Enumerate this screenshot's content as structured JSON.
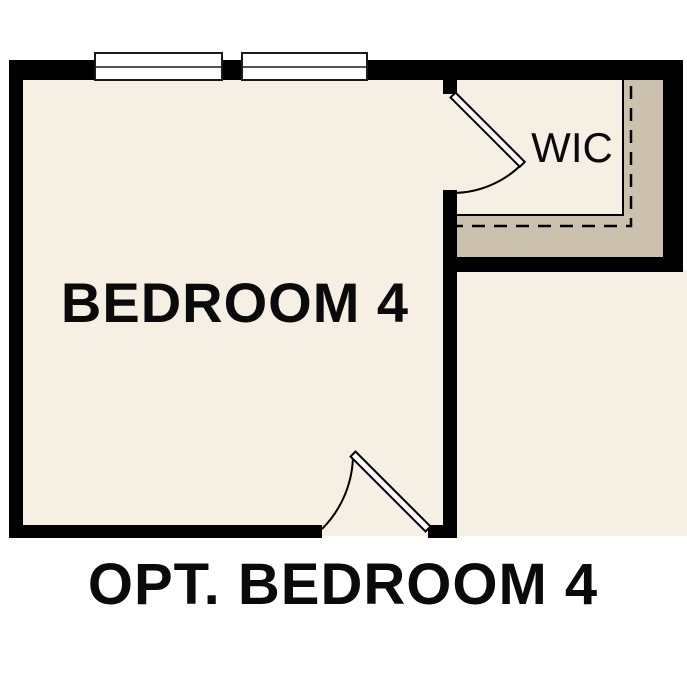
{
  "plan": {
    "caption": "OPT. BEDROOM 4",
    "rooms": [
      {
        "id": "bedroom4",
        "label": "BEDROOM 4"
      },
      {
        "id": "wic",
        "label": "WIC"
      }
    ]
  },
  "colors": {
    "background": "#ffffff",
    "wall": "#000000",
    "floor": "#f6efe3",
    "closet_shelf": "#cbc1ac",
    "window_fill": "#ffffff",
    "door_leaf": "#ffffff",
    "line": "#000000"
  }
}
